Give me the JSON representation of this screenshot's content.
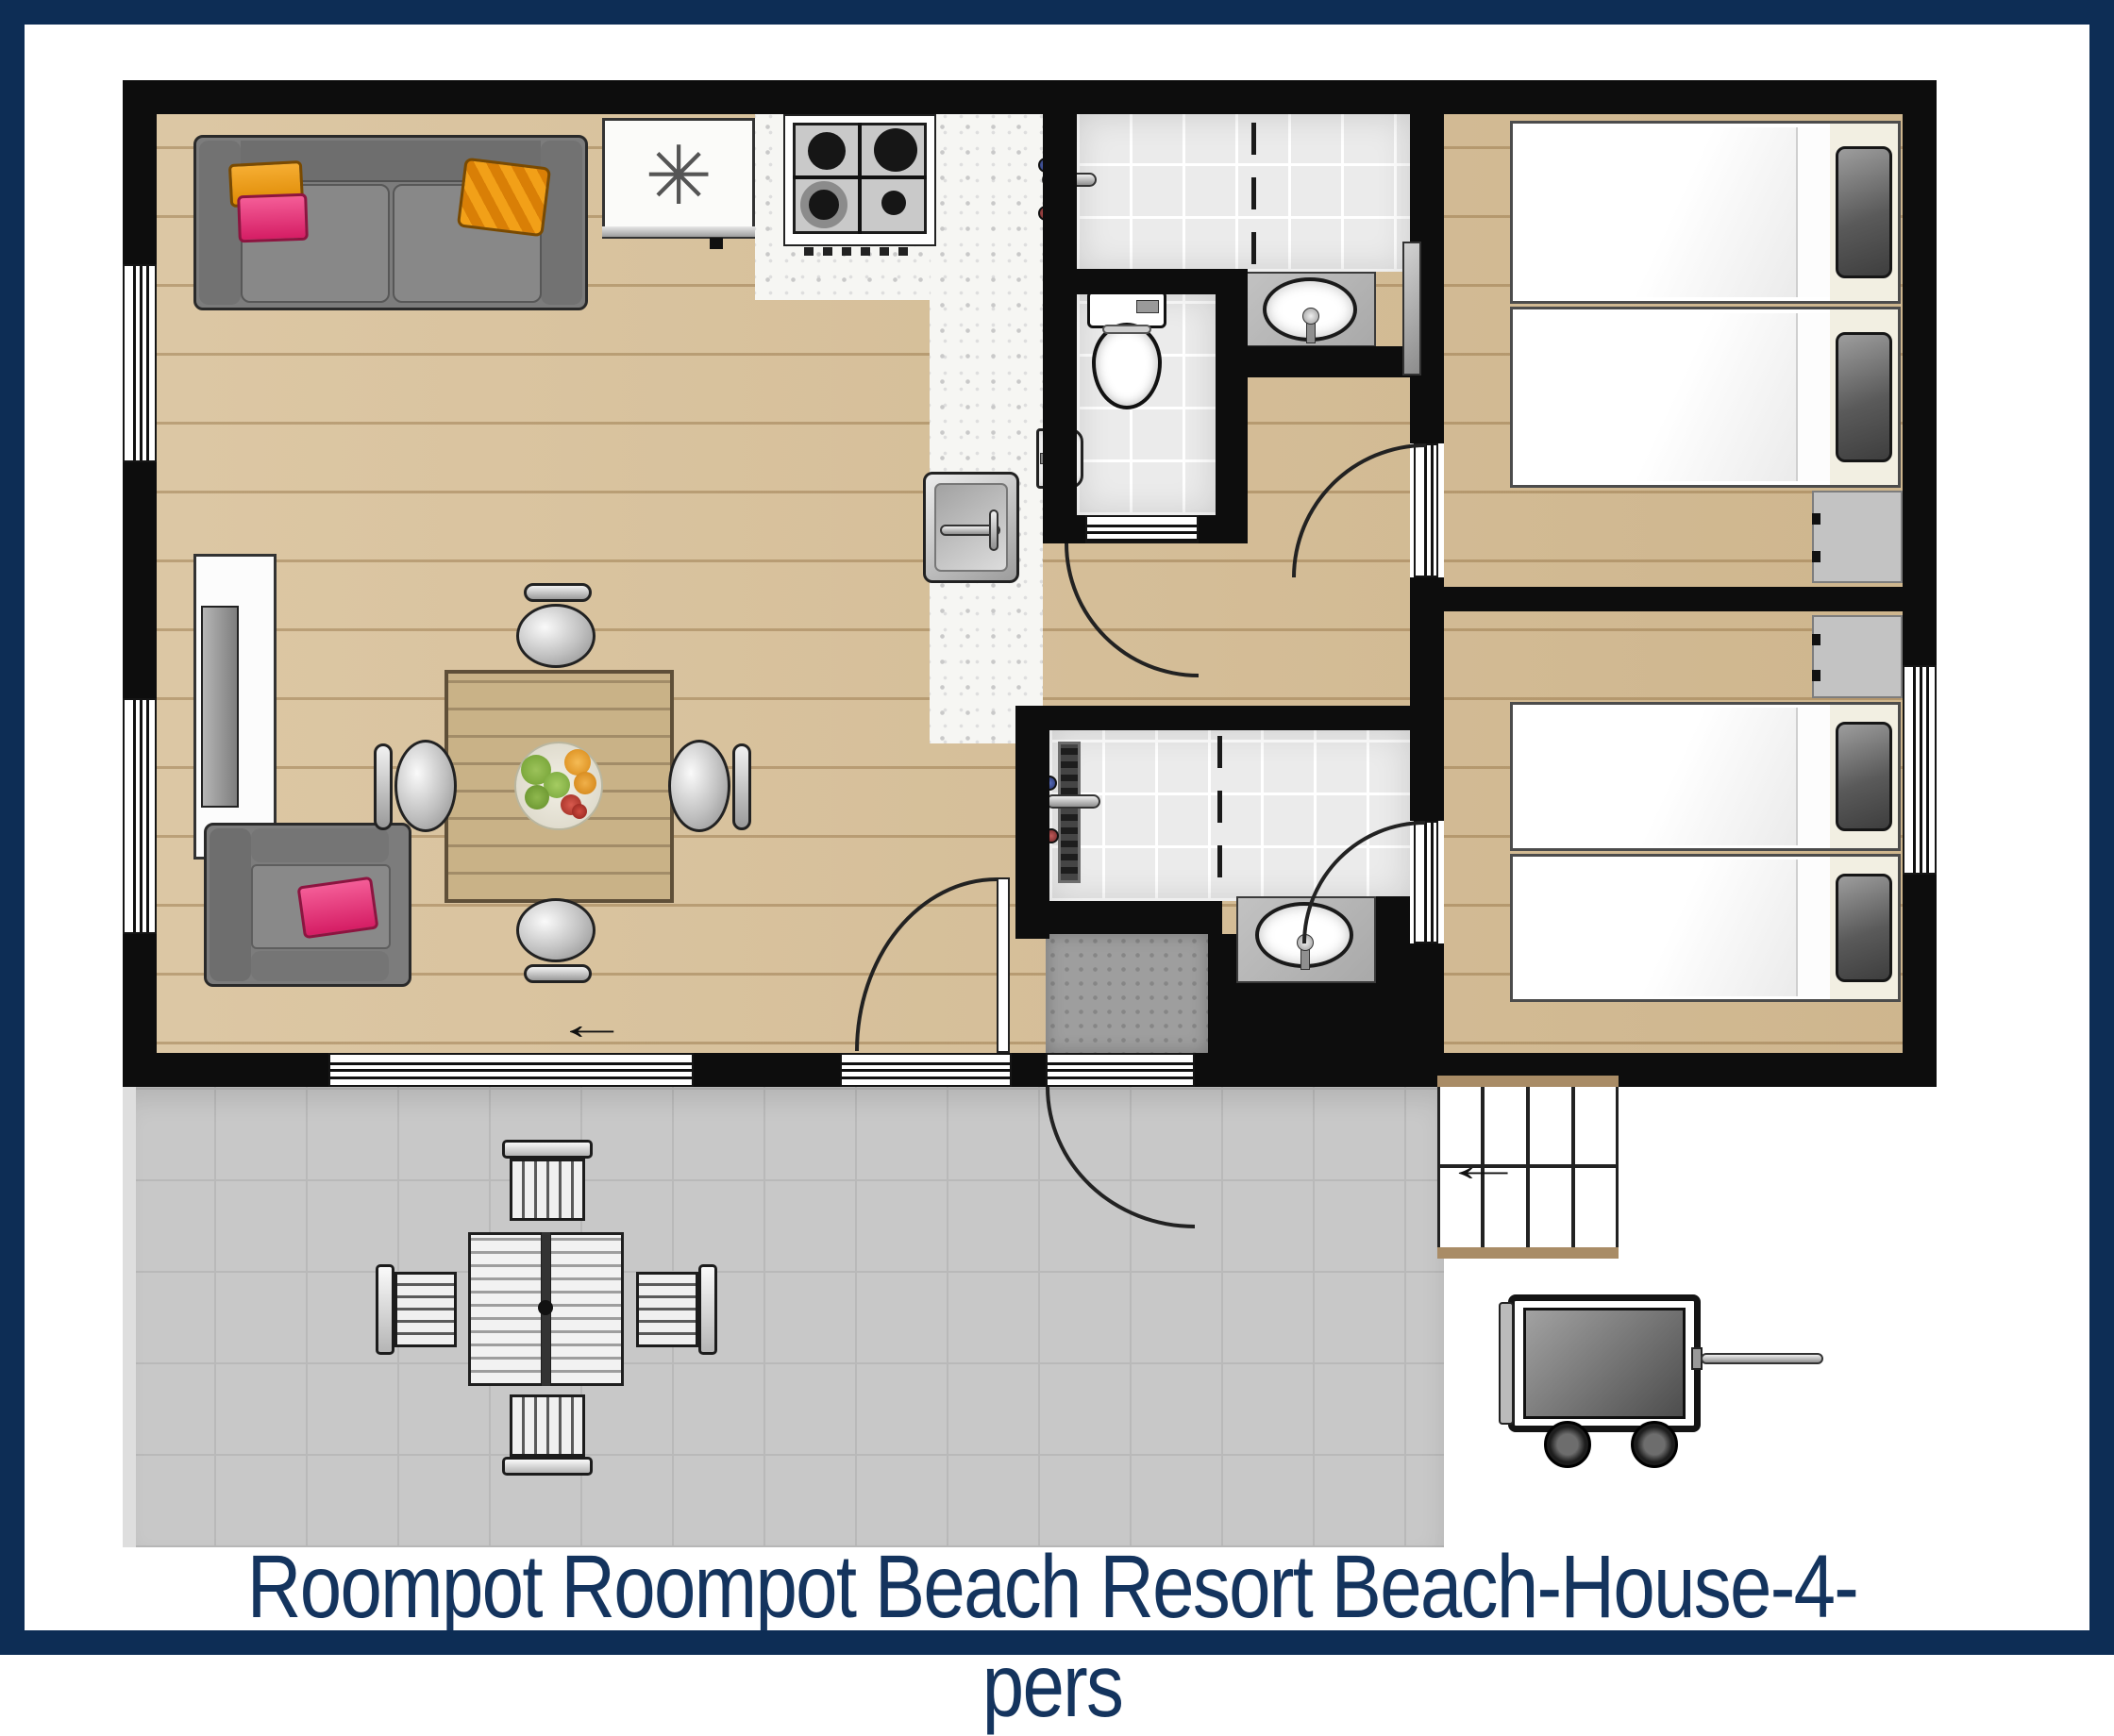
{
  "title": "Roompot Roompot Beach Resort Beach-House-4-pers",
  "icons": {
    "freezer_symbol": "✳",
    "sliding_door_direction": "←",
    "stairs_direction": "←"
  },
  "colors": {
    "frame_navy": "#0d2d55",
    "title_navy": "#14345e",
    "wall": "#0d0d0d",
    "wood": "#d8c098",
    "tile": "#ebebeb",
    "terrace": "#c8c8c8",
    "counter": "#f6f6f3",
    "sofa": "#7c7c7c",
    "orange": "#f29e1d",
    "pink": "#e93a7d",
    "wardrobe": "#c3c3c3",
    "mat": "#9e9e9e"
  },
  "rooms": [
    "living-room",
    "kitchen",
    "bathroom-1",
    "wc",
    "hallway",
    "bedroom-1",
    "bedroom-2",
    "bathroom-2",
    "terrace"
  ],
  "furniture": [
    "sofa",
    "armchair",
    "tv-sideboard",
    "dining-table",
    "dining-chairs",
    "fruit-bowl",
    "fridge-freezer",
    "gas-hob",
    "kitchen-sink",
    "shower",
    "toilet",
    "hand-basin",
    "washbasin",
    "single-beds",
    "wardrobes",
    "outdoor-table",
    "outdoor-chairs",
    "stairs",
    "beach-wagon"
  ]
}
